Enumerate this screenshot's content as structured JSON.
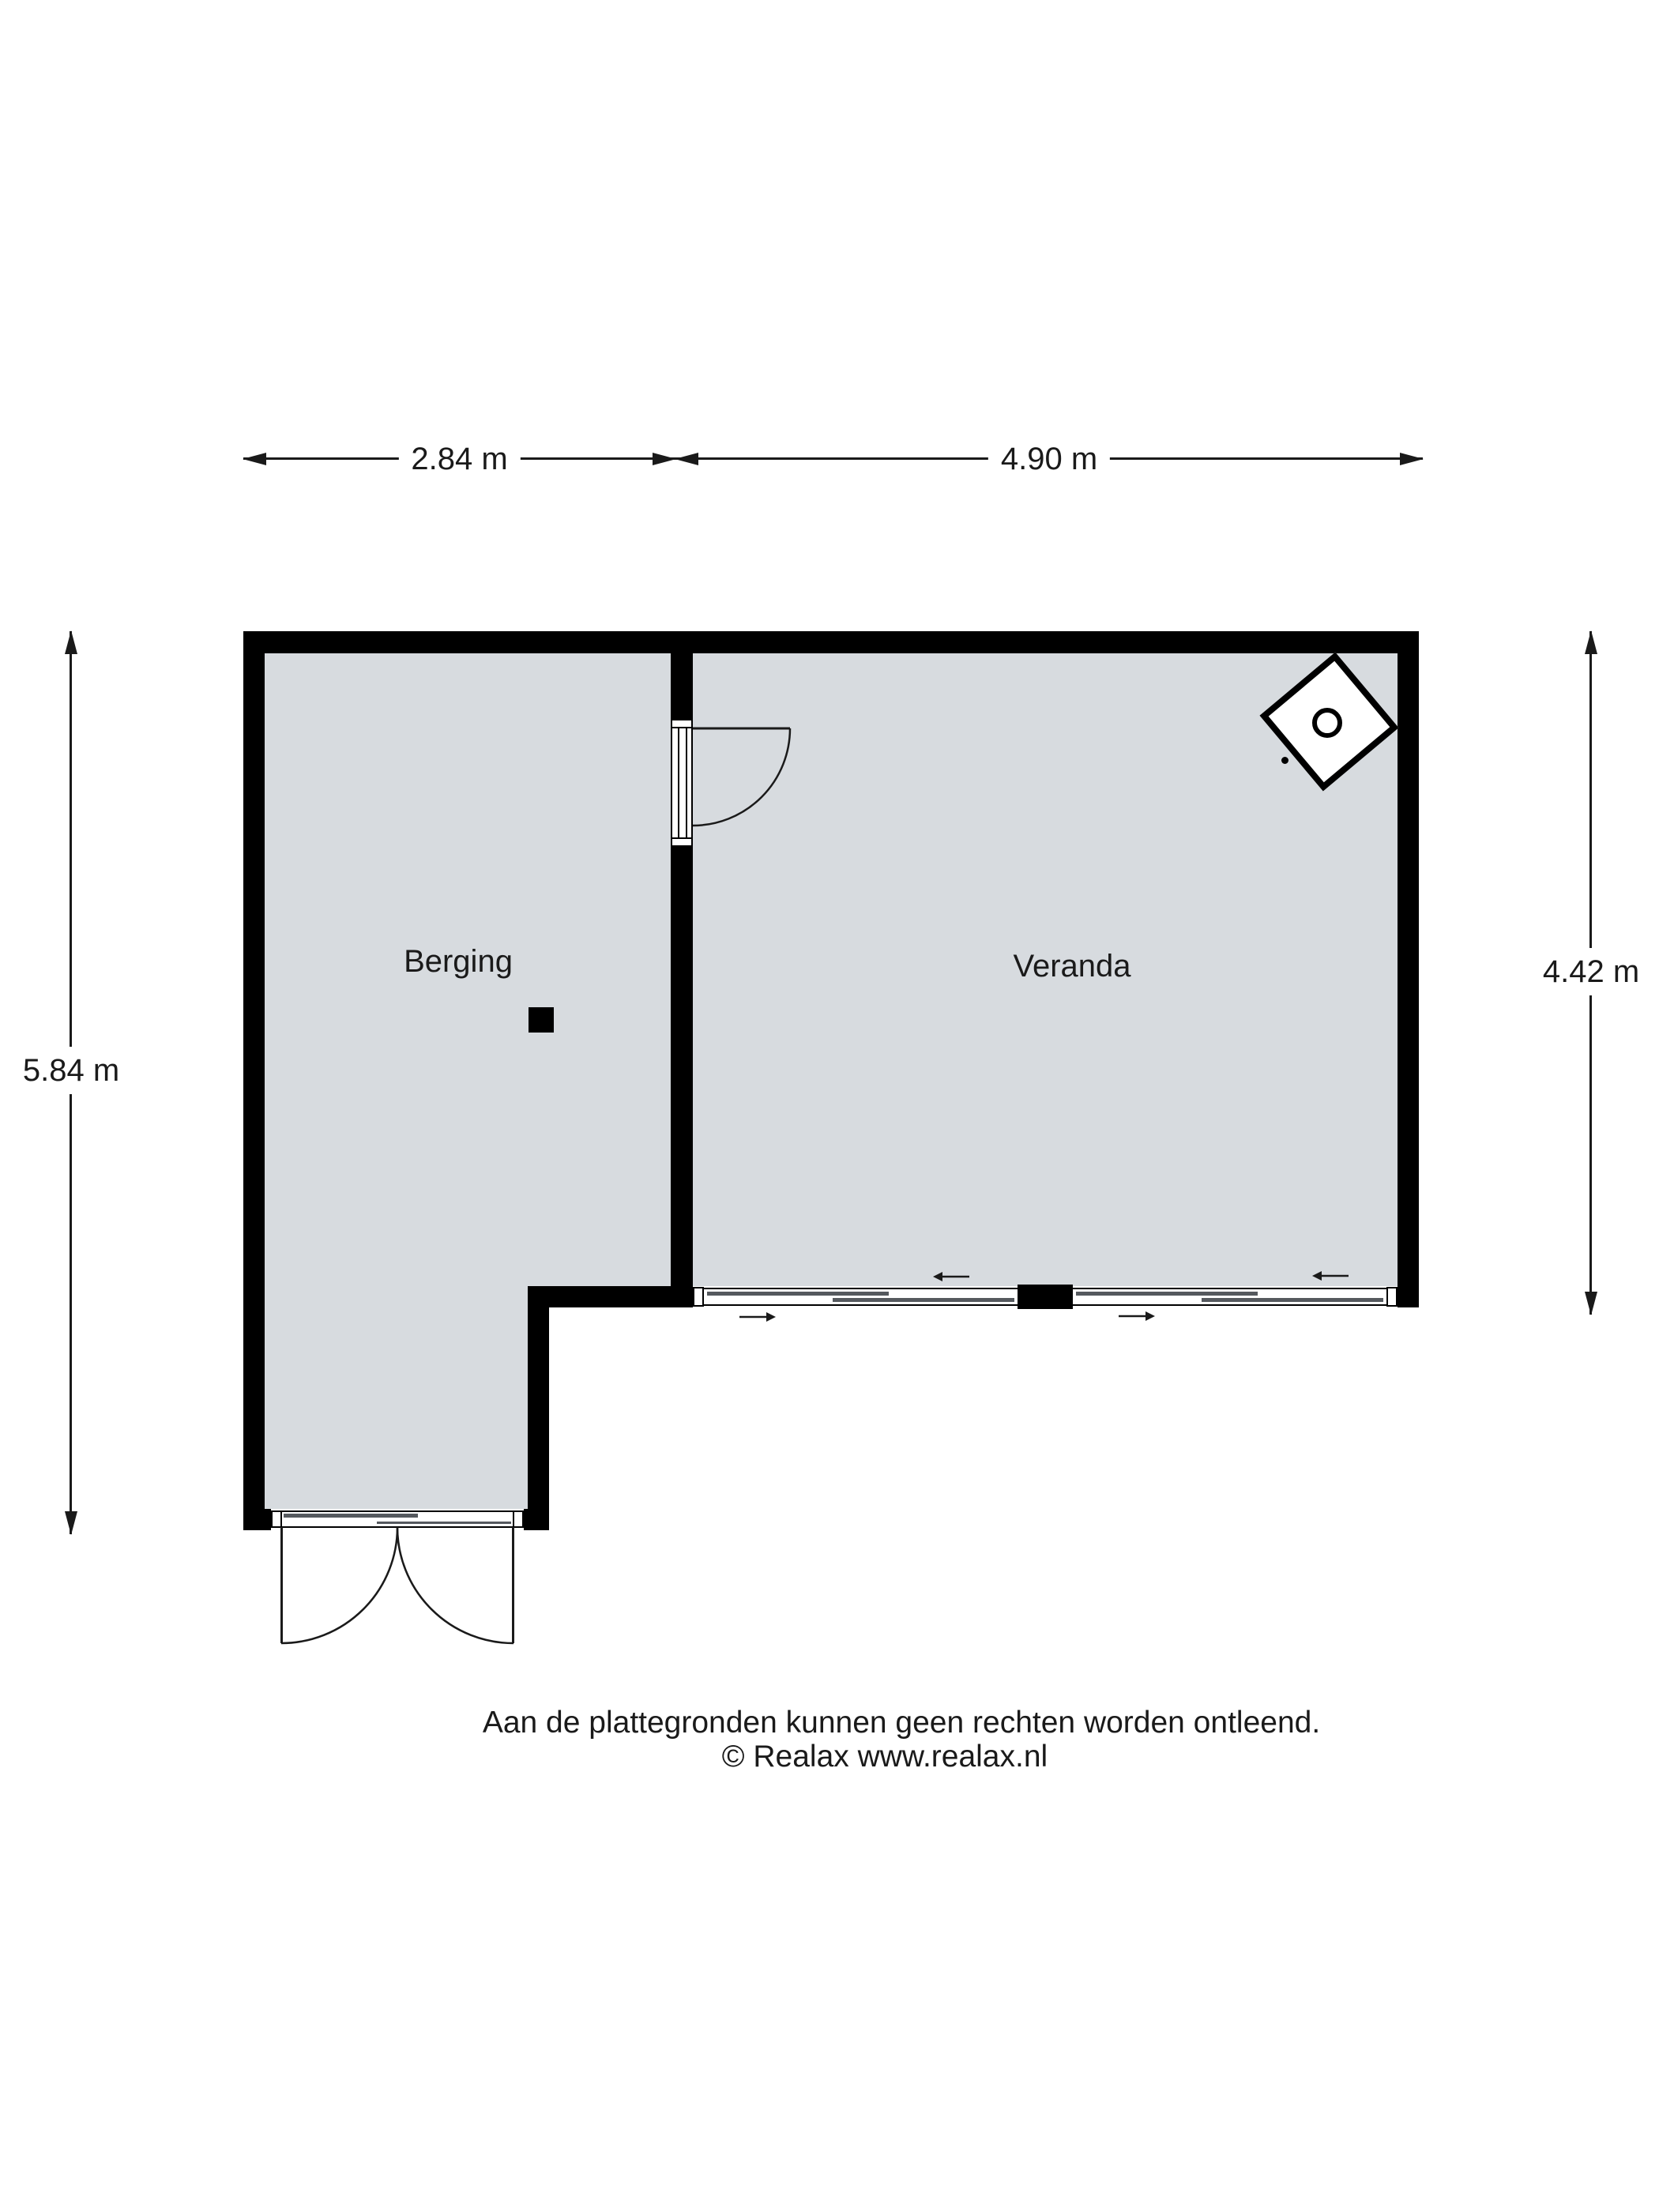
{
  "floorplan": {
    "rooms": [
      {
        "name": "Berging"
      },
      {
        "name": "Veranda"
      }
    ],
    "dimensions": {
      "top_berging": "2.84 m",
      "top_veranda": "4.90 m",
      "left_total": "5.84 m",
      "right_veranda": "4.42 m"
    },
    "footer": {
      "disclaimer": "Aan de plattegronden kunnen geen rechten worden ontleend.",
      "copyright": "© Realax www.realax.nl"
    },
    "colors": {
      "wall": "#000000",
      "floor": "#d7dbdf",
      "background": "#ffffff",
      "text": "#1a1a1a"
    }
  }
}
